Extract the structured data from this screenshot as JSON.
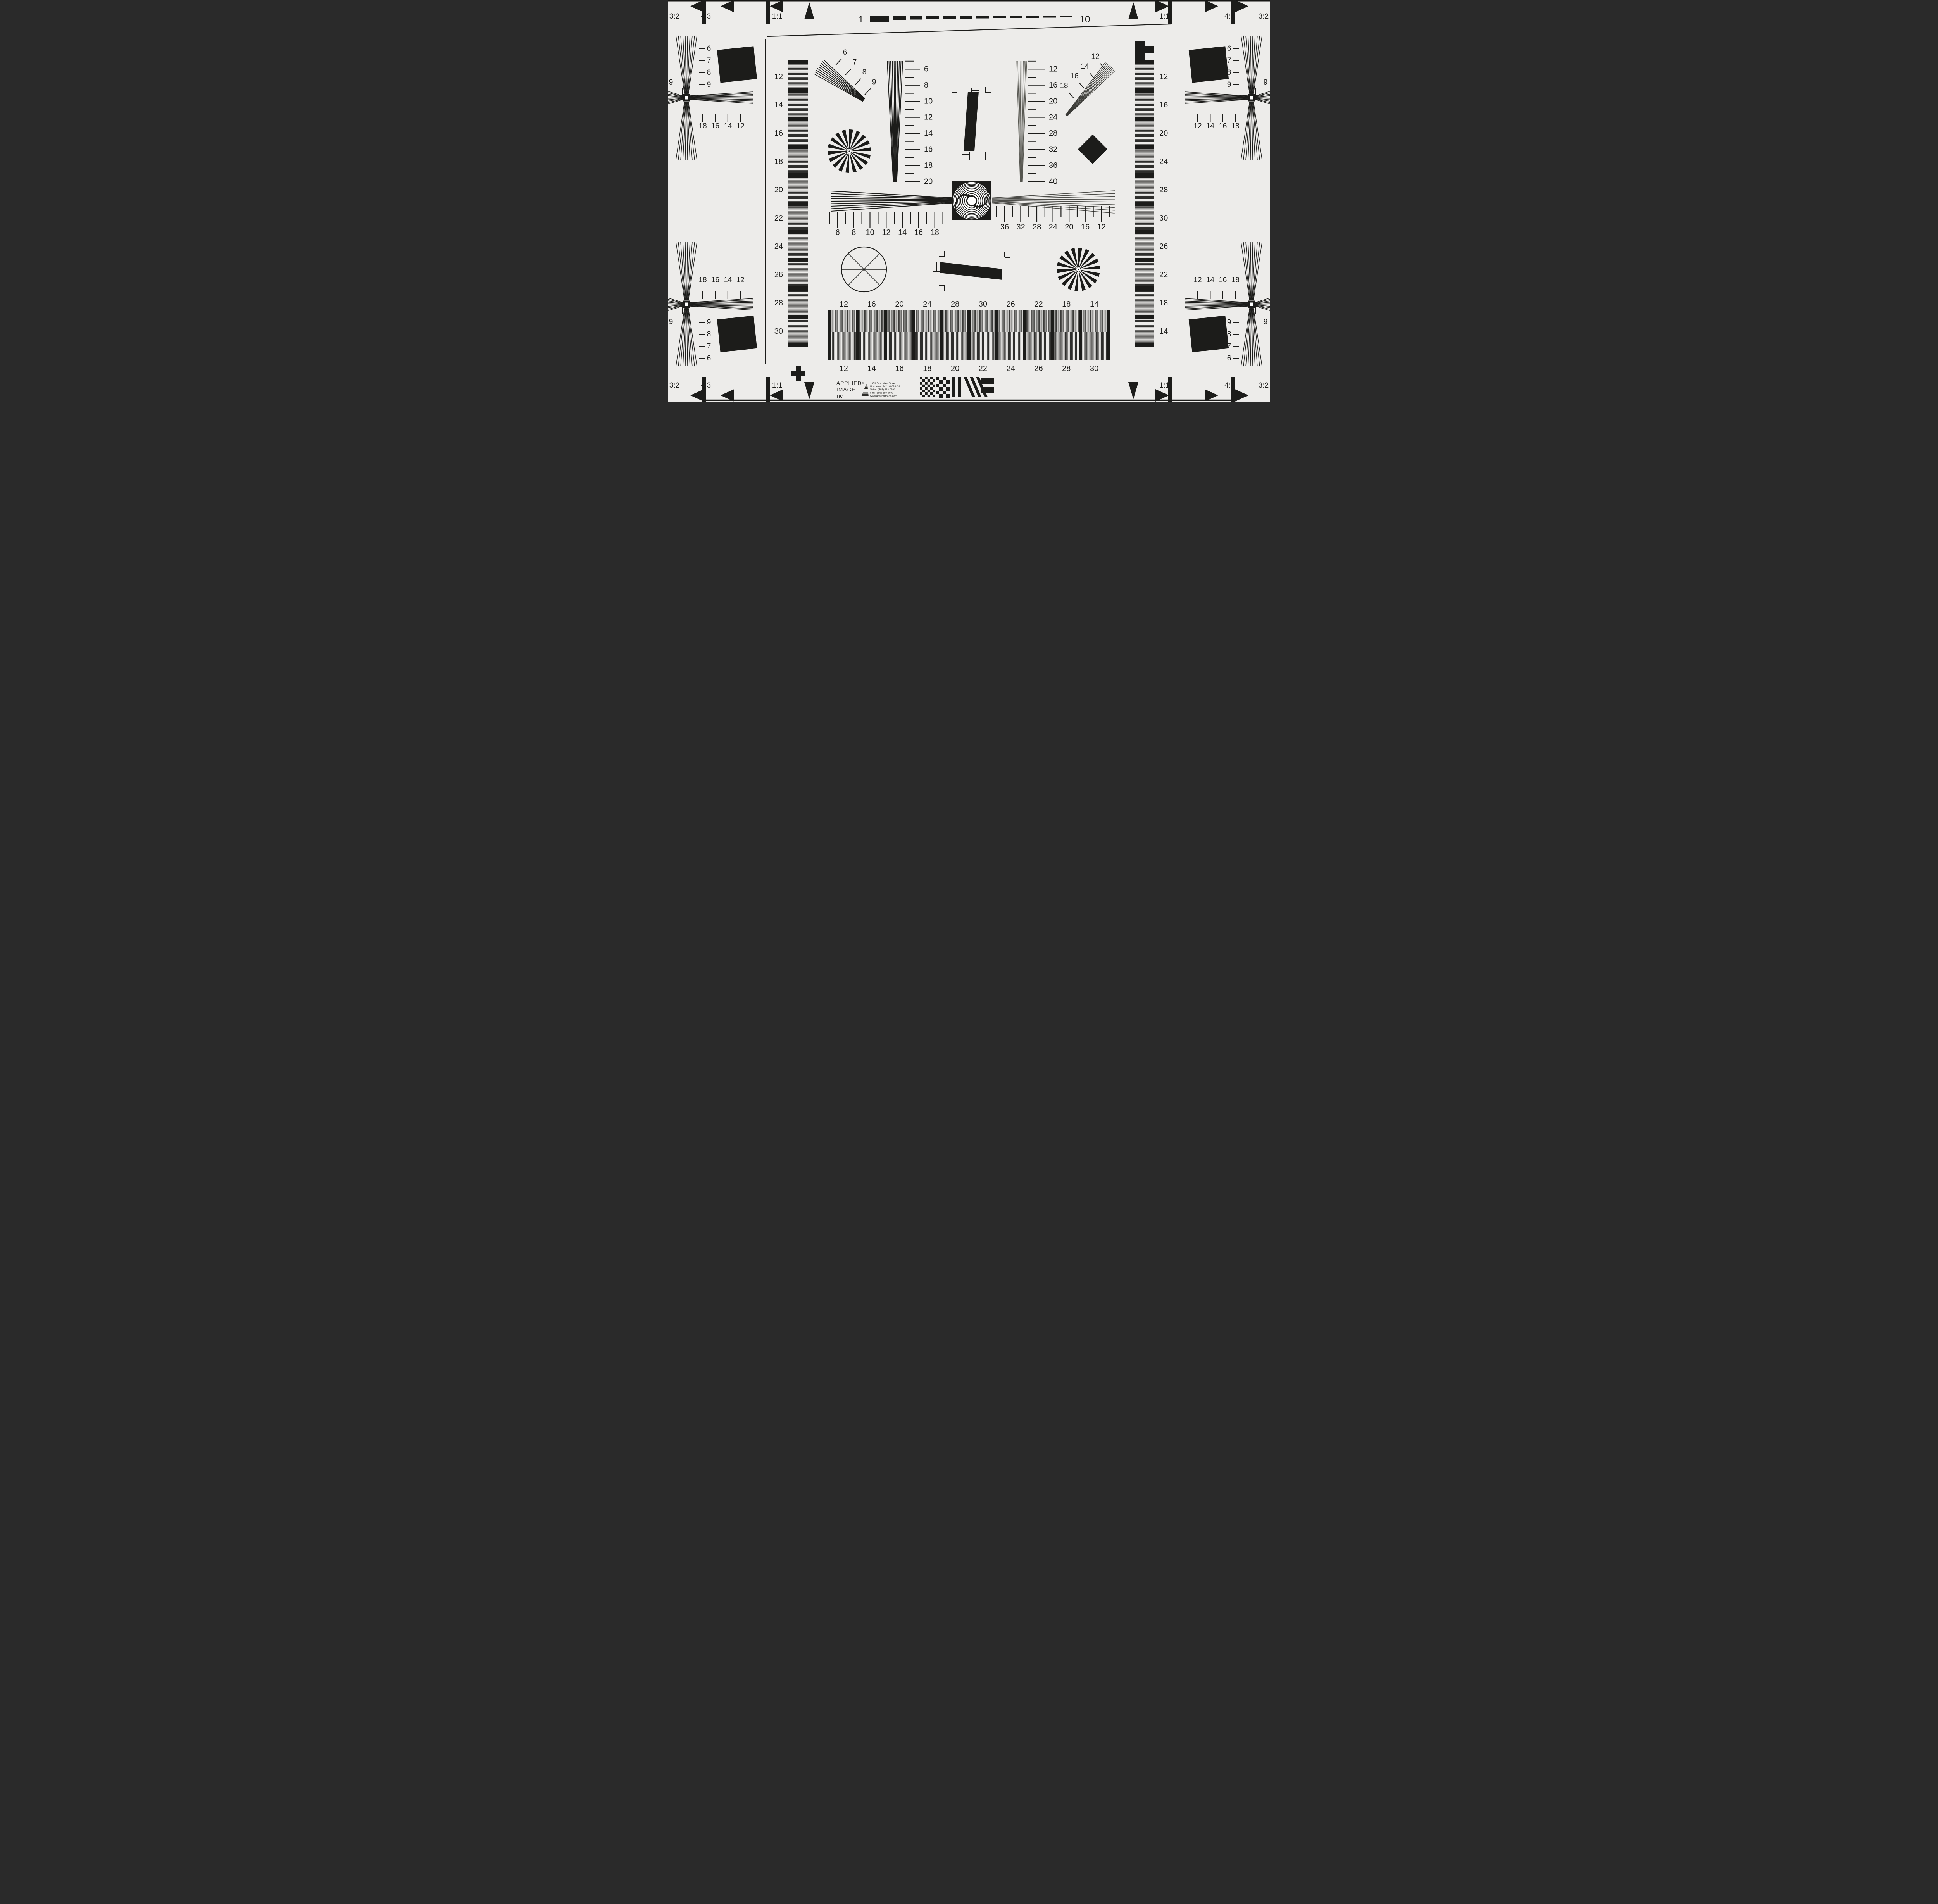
{
  "title": "ISO 12233 resolution test chart (Applied Image Inc)",
  "colors": {
    "paper": "#edecea",
    "paper_edge": "#e4e3e1",
    "ink": "#1c1c1a",
    "gray_line": "#55554f",
    "stripe_gray": "#a7a6a4",
    "top_edge_line": "#151513"
  },
  "corner_labels": {
    "top_left": [
      "3:2",
      "4:3",
      "1:1"
    ],
    "top_right": [
      "1:1",
      "4:3",
      "3:2"
    ],
    "bottom_left": [
      "3:2",
      "4:3",
      "1:1"
    ],
    "bottom_right": [
      "1:1",
      "4:3",
      "3:2"
    ]
  },
  "top_ruler": {
    "left": "1",
    "right": "10"
  },
  "left_bar_labels": [
    "12",
    "14",
    "16",
    "18",
    "20",
    "22",
    "24",
    "26",
    "28",
    "30"
  ],
  "right_bar_labels": [
    "12",
    "16",
    "20",
    "24",
    "28",
    "30",
    "26",
    "22",
    "18",
    "14"
  ],
  "quadrants": {
    "top_left": {
      "vertical": [
        "6",
        "7",
        "8",
        "9"
      ],
      "horizontal": [
        "18",
        "16",
        "14",
        "12"
      ],
      "edge": "9"
    },
    "top_right": {
      "vertical": [
        "6",
        "7",
        "8",
        "9"
      ],
      "horizontal": [
        "12",
        "14",
        "16",
        "18"
      ],
      "edge": "9"
    },
    "bottom_left": {
      "vertical": [
        "9",
        "8",
        "7",
        "6"
      ],
      "horizontal": [
        "18",
        "16",
        "14",
        "12"
      ],
      "edge": "9"
    },
    "bottom_right": {
      "vertical": [
        "9",
        "8",
        "7",
        "6"
      ],
      "horizontal": [
        "12",
        "14",
        "16",
        "18"
      ],
      "edge": "9"
    }
  },
  "slant_wedge_top_left": [
    "6",
    "7",
    "8",
    "9"
  ],
  "slant_wedge_top_right": [
    "12",
    "14",
    "16",
    "18"
  ],
  "v_wedge_left": [
    "6",
    "8",
    "10",
    "12",
    "14",
    "16",
    "18",
    "20"
  ],
  "v_wedge_right": [
    "12",
    "16",
    "20",
    "24",
    "28",
    "32",
    "36",
    "40"
  ],
  "h_wedge_left": [
    "6",
    "8",
    "10",
    "12",
    "14",
    "16",
    "18"
  ],
  "h_wedge_right": [
    "36",
    "32",
    "28",
    "24",
    "20",
    "16",
    "12"
  ],
  "grayscale": {
    "top": [
      "12",
      "16",
      "20",
      "24",
      "28",
      "30",
      "26",
      "22",
      "18",
      "14"
    ],
    "bottom": [
      "12",
      "14",
      "16",
      "18",
      "20",
      "22",
      "24",
      "26",
      "28",
      "30"
    ]
  },
  "logo": {
    "name_line1": "APPLIED",
    "registered": "®",
    "name_line2": "IMAGE",
    "name_line3": "Inc",
    "address": [
      "1653 East Main Street",
      "Rochester, NY  14609  USA",
      "Voice:   (585) 482-0300",
      "Fax:      (585) 288-5989",
      "www.appliedimage.com"
    ]
  }
}
